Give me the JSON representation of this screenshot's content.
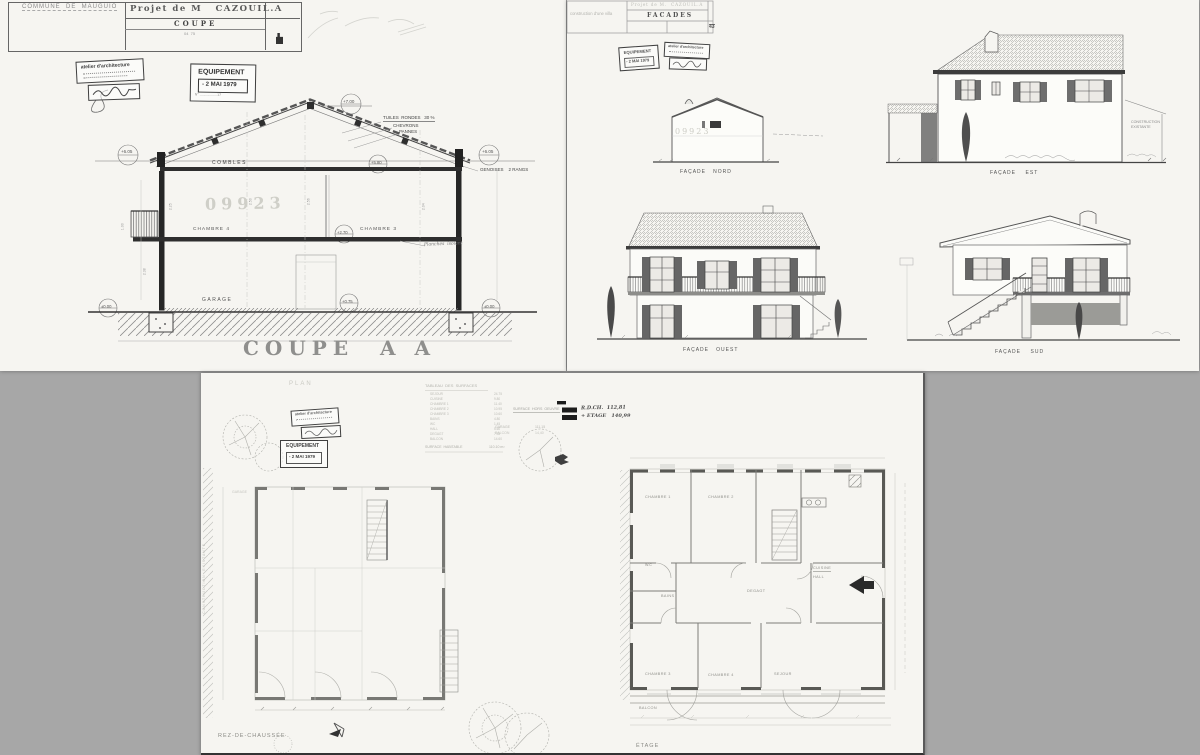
{
  "colors": {
    "bg": "#a7a7a7",
    "paper": "#f6f5f1",
    "ink": "#4a4a4a",
    "faint": "#b9b9b4",
    "black": "#222222"
  },
  "coupe": {
    "tb": {
      "commune": "COMMUNE  DE  MAUGUIO",
      "project": "Projet de M   CAZOUIL.A",
      "drawing": "COUPE",
      "ref": "04  75"
    },
    "stamps": {
      "atelier": "atelier d'architecture",
      "equip1": "EQUIPEMENT",
      "equip2": "- 2 MAI 1979",
      "equip3": "N° ..................17"
    },
    "roof": {
      "tuiles": "TUILES  RONDES   30 %",
      "chevrons": "CHEVRONS",
      "pannes": "PANNES",
      "genoises": "GENOISES    2 RANGS"
    },
    "levels": {
      "ridge": "+7.00",
      "eaveL": "+6.05",
      "eaveR": "+6.05",
      "combles": "+5.80",
      "etage": "+2.70",
      "rdc": "+0.75",
      "groundL": "±0.00",
      "groundR": "±0.00"
    },
    "rooms": {
      "combles": "COMBLES",
      "chL": "CHAMBRE 4",
      "chR": "CHAMBRE 3",
      "garage": "GARAGE"
    },
    "notes": {
      "planches": "Planches  isolant",
      "watermark": "09923"
    },
    "dims": [
      "2.25",
      "2.50",
      "2.56",
      "2.04",
      "1.00",
      "2.38"
    ],
    "caption": "COUPE  A A"
  },
  "facades": {
    "tb": {
      "left": "construction d'une villa",
      "project": "Projet de M.  CAZOUIL.A",
      "drawing": "FACADES",
      "num": "43"
    },
    "stamps": {
      "equip1": "EQUIPEMENT",
      "equip2": "- 2 MAI 1979",
      "atelier": "atelier d'architecture"
    },
    "captions": {
      "nord": "FAÇADE   NORD",
      "est": "FAÇADE    EST",
      "ouest": "FAÇADE   OUEST",
      "sud": "FAÇADE    SUD"
    },
    "existing": "CONSTRUCTION\nEXISTANTE",
    "watermark": "09923"
  },
  "plan": {
    "tb_title": "PLAN",
    "stamps": {
      "atelier": "atelier d'architecture",
      "equip1": "EQUIPEMENT",
      "equip2": "- 2 MAI 1979"
    },
    "table": {
      "title": "TABLEAU  DES  SURFACES",
      "rows": [
        [
          "SEJOUR",
          "24.75"
        ],
        [
          "CUISINE",
          "9.80"
        ],
        [
          "CHAMBRE 1",
          "11.40"
        ],
        [
          "CHAMBRE 2",
          "10.95"
        ],
        [
          "CHAMBRE 3",
          "10.60"
        ],
        [
          "BAINS",
          "4.80"
        ],
        [
          "WC",
          "1.45"
        ],
        [
          "HALL",
          "5.60"
        ],
        [
          "DEGAGT",
          "7.35"
        ],
        [
          "BALCON",
          "14.60"
        ]
      ],
      "total": "SURFACE  HABITABLE",
      "total_value": "110.10 m²"
    },
    "surface": {
      "l1": "SURFACE  HORS  OEUVRE",
      "v1": "R.D.CH.  112,81",
      "v2": "+ ETAGE   140,99",
      "l3": "GARAGE",
      "v3": "111,15",
      "l4": "BALCON",
      "v4": "14,40"
    },
    "captions": {
      "rdc": "REZ-DE-CHAUSSÉE",
      "etage": "ÉTAGE"
    },
    "rooms": {
      "ch1": "CHAMBRE 1",
      "ch2": "CHAMBRE 2",
      "ch3": "CHAMBRE 3",
      "ch4": "CHAMBRE 4",
      "sejour": "SEJOUR",
      "hall": "HALL",
      "cuisine": "CUISINE",
      "bains": "BAINS",
      "wc": "W.C",
      "degagt": "DEGAGT",
      "balcon": "BALCON",
      "garage": "GARAGE"
    },
    "existing": "CONSTRUCTION  EXISTANTE"
  }
}
